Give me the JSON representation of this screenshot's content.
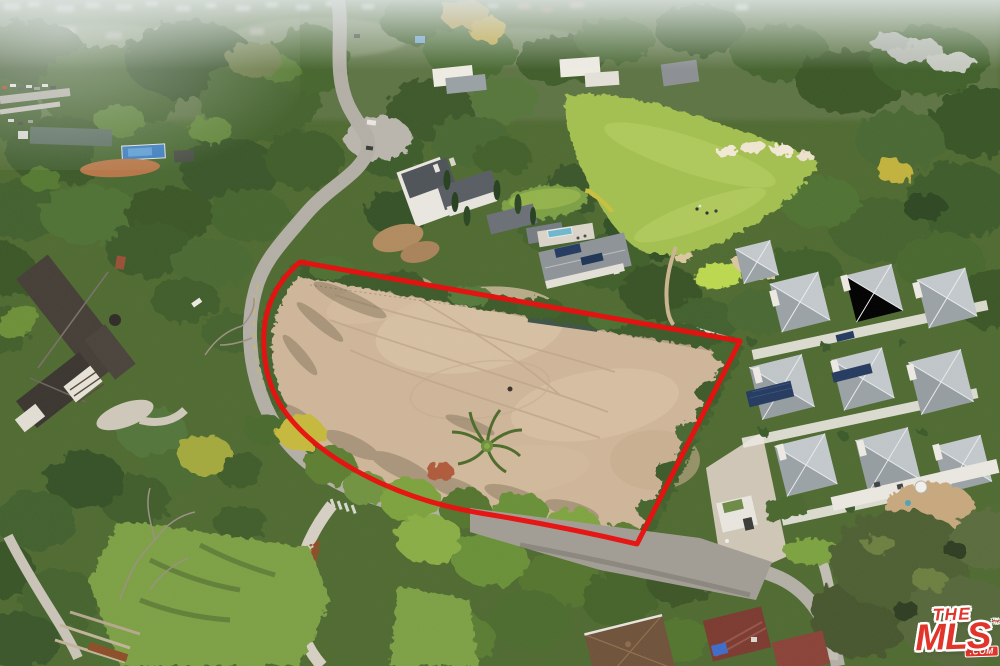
{
  "photo": {
    "kind_label": "aerial-drone-photograph",
    "subject_label": "vacant-lot-outlined-in-red",
    "landmarks": [
      "golf-course-fairway",
      "golf-green-with-bunkers",
      "estate-mansion",
      "tudor-style-house",
      "modern-pyramid-roof-compound",
      "winding-road",
      "vacant-dirt-lot",
      "tree-canopy",
      "distant-hazy-city"
    ]
  },
  "boundary": {
    "color": "#e81111",
    "stroke_width": 5
  },
  "watermark": {
    "the": "THE",
    "mls": "MLS",
    "tm": "™",
    "com": ".COM"
  },
  "palette": {
    "dirt": "#cfb69a",
    "dirt_light": "#dcc8ac",
    "fairway": "#a3c050",
    "putting_green": "#bcd94f",
    "sand": "#f0e6d0",
    "tree_dark": "#3a5629",
    "tree_mid": "#4c6b2f",
    "tree_yellow": "#b1a93f",
    "road": "#b3afa6",
    "roof_gray": "#9ba2a6",
    "roof_dark": "#4e5358",
    "lawn": "#7da045",
    "pool_blue": "#6fb7cf",
    "court_blue": "#3e7ec0",
    "shed_maroon": "#7c3a30",
    "logo_red": "#e1342b"
  },
  "css_vars": {
    "wm-red": "#e1342b"
  }
}
